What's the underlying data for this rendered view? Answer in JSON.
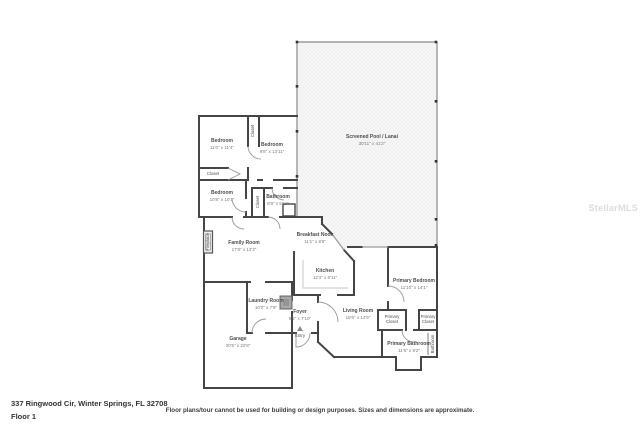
{
  "page": {
    "address": "337 Ringwood Cir, Winter Springs, FL 32708",
    "floor_label": "Floor 1",
    "disclaimer": "Floor plans/tour cannot be used for building or design purposes. Sizes and dimensions are approximate.",
    "watermark": "StellarMLS"
  },
  "colors": {
    "wall": "#454545",
    "enclosure_line": "#9b9b9b",
    "pool_hatch": "#ececec",
    "label_text": "#4d4d4d",
    "dims_text": "#7a7a7a",
    "watermark_text": "#dcdcdc"
  },
  "rooms": {
    "bedroom1": {
      "name": "Bedroom",
      "dims": "11'0\" x 11'4\""
    },
    "closet_a": {
      "name": "Closet"
    },
    "bedroom2": {
      "name": "Bedroom",
      "dims": "9'8\" x 13'11\""
    },
    "closet_hall": {
      "name": "Closet"
    },
    "bedroom3": {
      "name": "Bedroom",
      "dims": "10'8\" x 10'1\""
    },
    "closet_b": {
      "name": "Closet"
    },
    "bathroom": {
      "name": "Bathroom",
      "dims": "8'8\" x 5'11\""
    },
    "pool": {
      "name": "Screened Pool / Lanai",
      "dims": "30'11\" x 41'2\""
    },
    "family": {
      "name": "Family Room",
      "dims": "17'8\" x 13'3\""
    },
    "fireplace": {
      "name": "Fireplace"
    },
    "nook": {
      "name": "Breakfast Nook",
      "dims": "11'1\" x 8'8\""
    },
    "kitchen": {
      "name": "Kitchen",
      "dims": "12'4\" x 8'11\""
    },
    "laundry": {
      "name": "Laundry Room",
      "dims": "10'0\" x 7'9\""
    },
    "foyer": {
      "name": "Foyer",
      "dims": "5'2\" x 7'10\""
    },
    "entry": {
      "name": "Entry"
    },
    "garage": {
      "name": "Garage",
      "dims": "20'5\" x 22'8\""
    },
    "living": {
      "name": "Living Room",
      "dims": "18'6\" x 14'5\""
    },
    "primary_bedroom": {
      "name": "Primary Bedroom",
      "dims": "11'10\" x 14'1\""
    },
    "primary_closet_a": {
      "name": "Primary Closet"
    },
    "primary_closet_b": {
      "name": "Primary Closet"
    },
    "primary_bathroom": {
      "name": "Primary Bathroom",
      "dims": "11'6\" x 8'2\""
    },
    "bath_wc": {
      "name": "Bathroom"
    }
  }
}
